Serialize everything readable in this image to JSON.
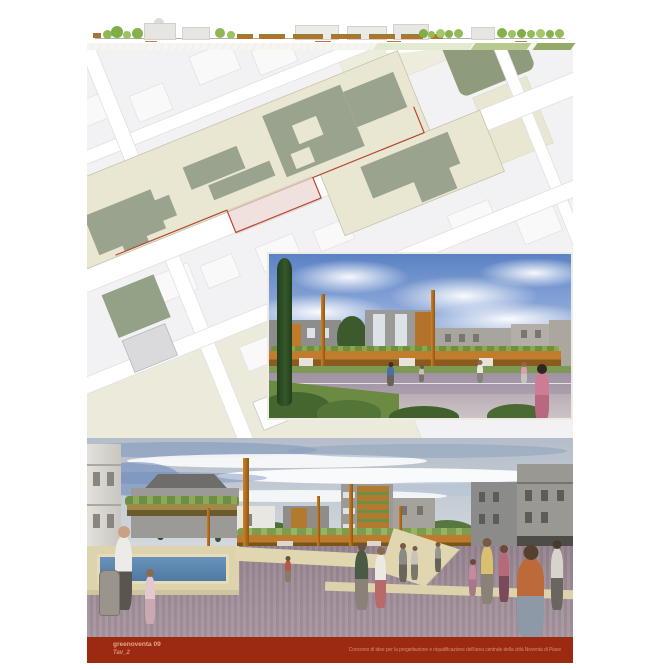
{
  "footer": {
    "project_title": "greenoventa 09",
    "sheet_label": "Tav_2",
    "competition_text": "Concorso di idee per la progettazione e riqualificazione dell'area centrale della città Noventa di Piave"
  },
  "colors": {
    "footer_background": "#9c2a10",
    "footer_text": "#e2a68d",
    "accent_orange": "#c4761f",
    "canopy_orange": "#b5722a",
    "plan_area_beige": "#e9e7d1",
    "plan_building_green": "#99a38d",
    "plan_park_green": "#8e9c7c",
    "plan_red_boundary": "#b34a30",
    "plaza_mauve": "#97858f",
    "stone_cream": "#e0d6b0",
    "pool_blue": "#5d87ae",
    "render_sky_blue": "#6f93cf",
    "vegetation_green": "#7d9c50"
  }
}
